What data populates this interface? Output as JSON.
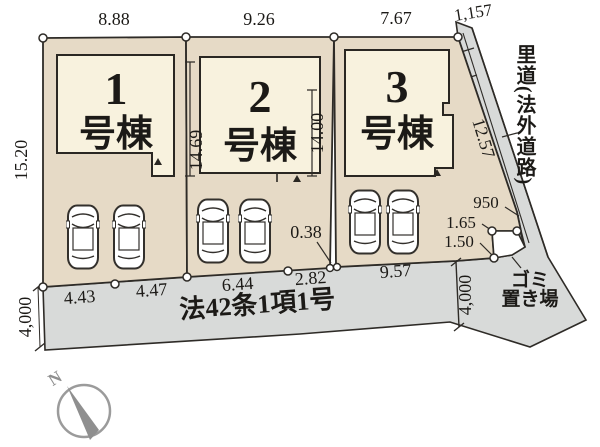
{
  "diagram": {
    "buildings": [
      {
        "number": "1",
        "label": "号棟"
      },
      {
        "number": "2",
        "label": "号棟"
      },
      {
        "number": "3",
        "label": "号棟"
      }
    ],
    "dimensions": {
      "top": {
        "lot1": "8.88",
        "lot2": "9.26",
        "lot3": "7.67",
        "satomichi": "1,157"
      },
      "side": {
        "lot1_left": "15.20",
        "lot2_left": "14.69",
        "lot2_right": "14.00",
        "lot3_right": "12.57"
      },
      "bottom": {
        "seg1": "4.43",
        "seg2": "4.47",
        "seg3": "6.44",
        "seg4": "2.82",
        "seg5": "9.57"
      },
      "offset": "0.38",
      "road_width_left": "4,000",
      "road_width_right": "4,000",
      "trash_1": "950",
      "trash_2": "1.65",
      "trash_3": "1.50"
    },
    "labels": {
      "road_name": "法42条1項1号",
      "satomichi": "里道(法外道路)",
      "trash_line1": "ゴミ",
      "trash_line2": "置き場",
      "north": "N"
    },
    "colors": {
      "lot": "#e6dac6",
      "building": "#f8f2de",
      "road": "#d8dad9",
      "outline": "#2e2b27"
    }
  }
}
